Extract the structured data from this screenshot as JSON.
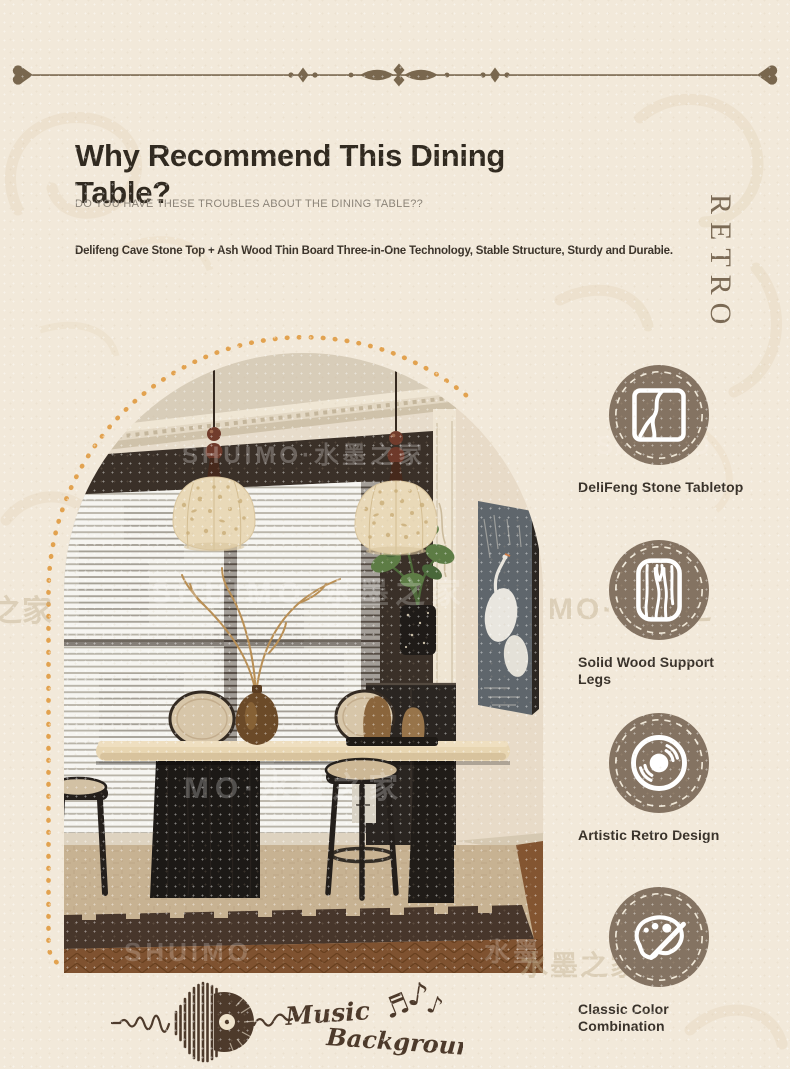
{
  "header": {
    "title": "Why Recommend This Dining Table?",
    "subtitle": "DO YOU HAVE THESE TROUBLES ABOUT THE DINING TABLE??",
    "feature_line": "Delifeng Cave Stone Top + Ash Wood Thin Board Three-in-One Technology, Stable Structure, Sturdy and Durable.",
    "side_label": "RETRO"
  },
  "features": [
    {
      "icon": "stone-tabletop-icon",
      "label": "DeliFeng Stone Tabletop"
    },
    {
      "icon": "wood-grain-icon",
      "label": "Solid Wood Support Legs"
    },
    {
      "icon": "vinyl-record-icon",
      "label": "Artistic Retro Design"
    },
    {
      "icon": "paint-palette-icon",
      "label": "Classic Color Combination"
    }
  ],
  "music_badge": {
    "word_1": "Music",
    "word_2": "Background",
    "note_1": "♬",
    "note_2": "♪",
    "note_3": "♪"
  },
  "watermarks": {
    "photo_top": "SHUIMO·水墨之家",
    "photo_mid": "SHUIMO·水墨之家",
    "photo_lower": "MO·水墨之家",
    "photo_bottom_left": "SHUIMO",
    "photo_bottom_right": "水墨之",
    "outside_circle_1": "SHUIMO",
    "outside_mid": "MO·水墨之",
    "outside_left": "之家",
    "outside_bottom": "水墨之家"
  },
  "colors": {
    "background": "#f2e9da",
    "accent_brown": "#79674e",
    "icon_circle": "#847362",
    "dot_arc": "#e2a24f",
    "title_text": "#312a20",
    "label_text": "#39322a",
    "music_ink": "#4d3a2b"
  }
}
